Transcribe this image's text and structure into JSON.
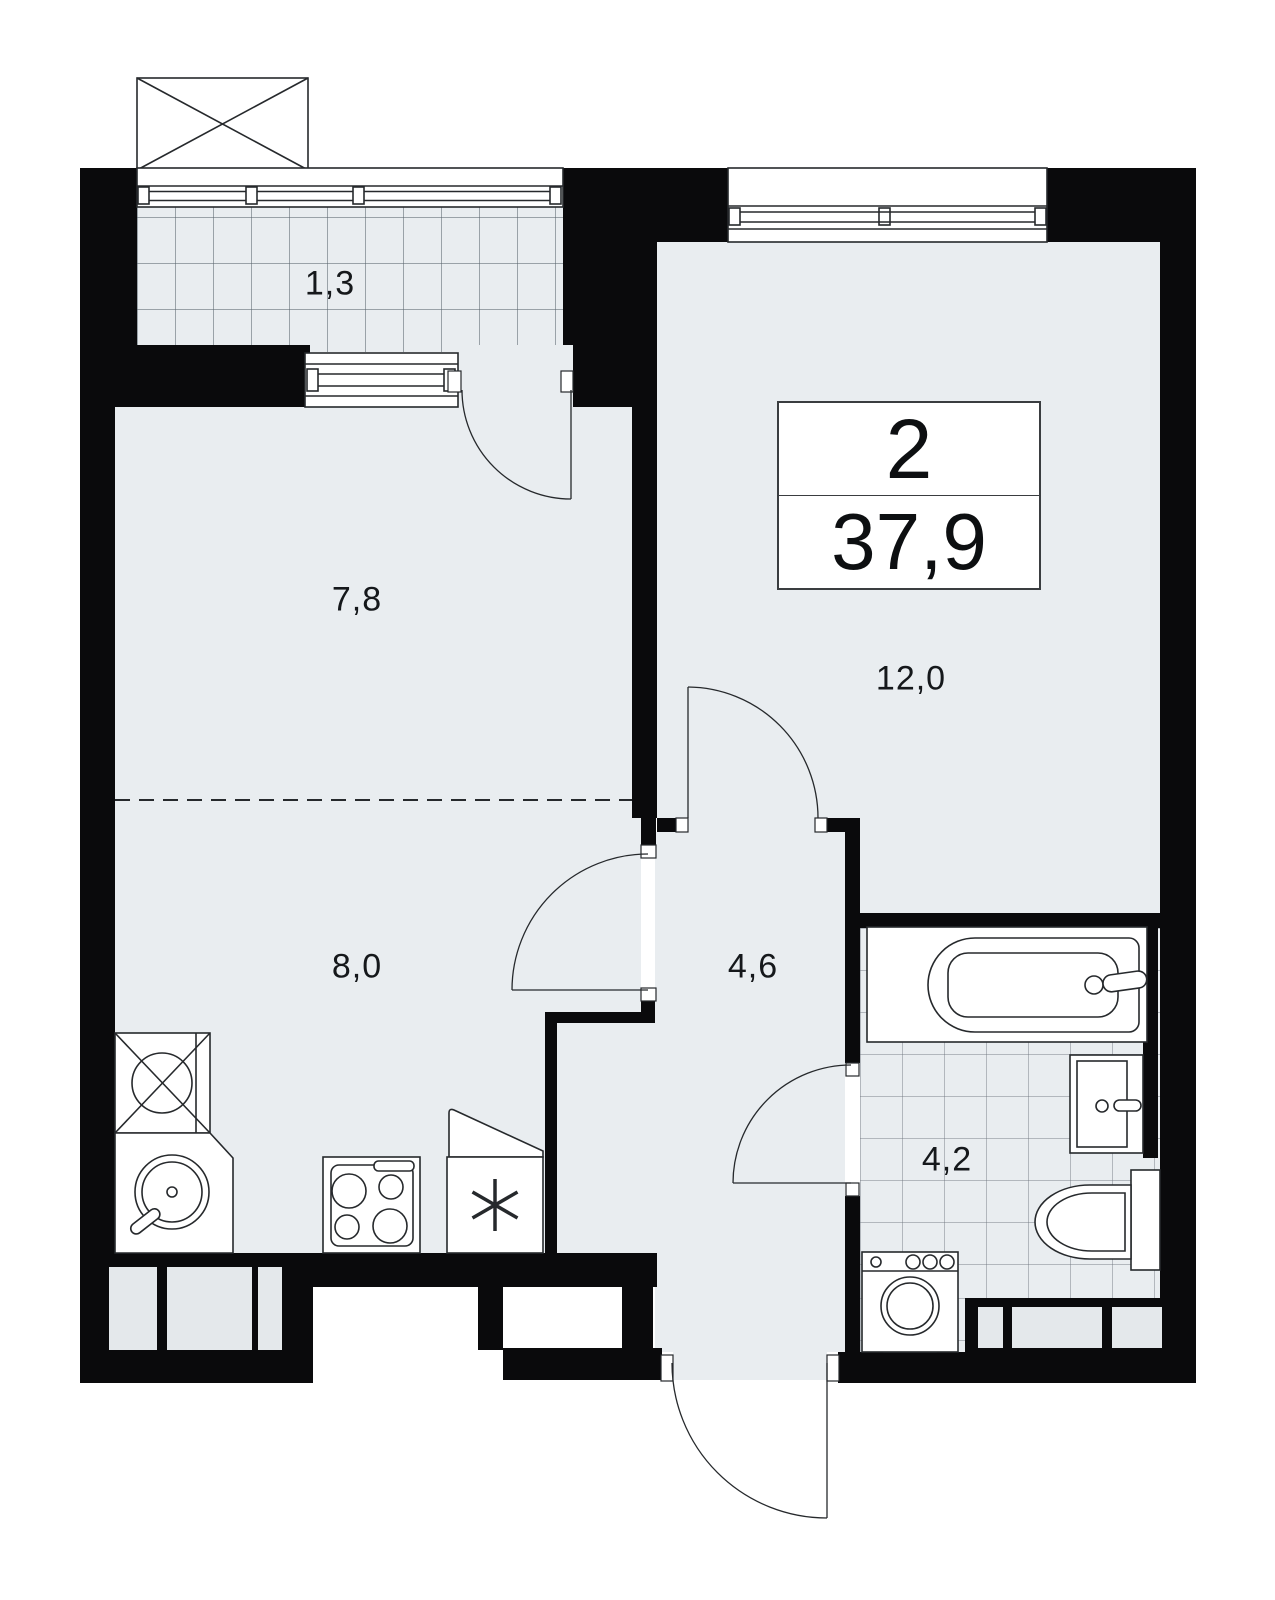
{
  "floorplan": {
    "summary": {
      "rooms_count": "2",
      "total_area": "37,9"
    },
    "rooms": {
      "balcony": {
        "area": "1,3"
      },
      "living": {
        "area": "7,8"
      },
      "kitchen": {
        "area": "8,0"
      },
      "bedroom": {
        "area": "12,0"
      },
      "hallway": {
        "area": "4,6"
      },
      "bathroom": {
        "area": "4,2"
      }
    },
    "colors": {
      "wall": "#0a0a0c",
      "floor": "#e9edf0",
      "outline": "#26292c"
    },
    "icons": {
      "vent_box": "crossed-rectangle",
      "hotplate": "crossed-circle",
      "kitchen_sink": "round-bowl-with-tap",
      "stove": "four-burner-hob",
      "fridge": "snowflake",
      "bathtub": "tub-with-tap",
      "bath_sink": "basin-with-tap",
      "toilet": "bowl-with-tank",
      "washing_machine": "front-loader-drum"
    }
  }
}
